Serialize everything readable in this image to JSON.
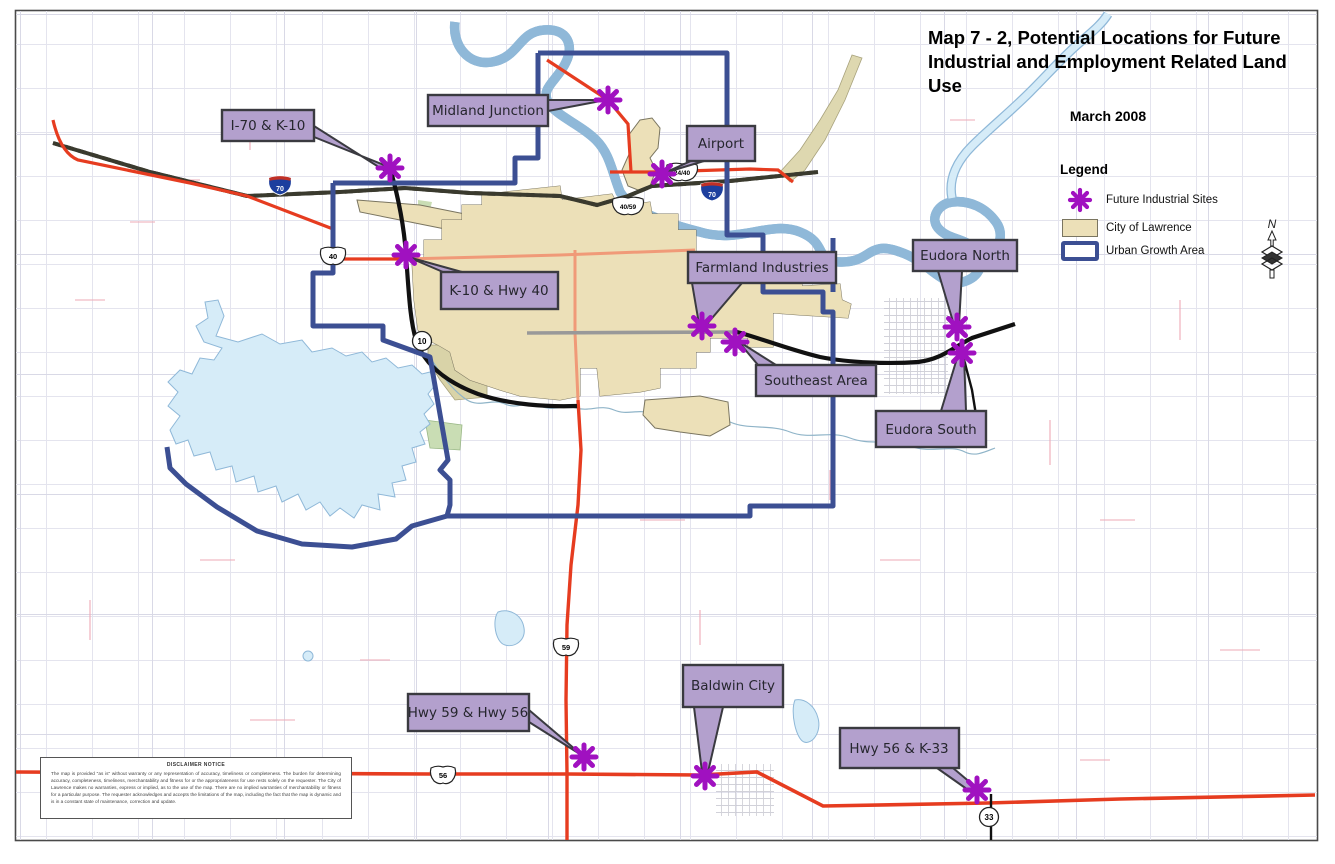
{
  "map": {
    "title": "Map 7 - 2, Potential Locations for Future Industrial and Employment Related Land Use",
    "date": "March 2008"
  },
  "legend": {
    "heading": "Legend",
    "items": [
      {
        "label": "Future Industrial Sites",
        "symbol": "purple-asterisk-marker",
        "color": "#A011C0"
      },
      {
        "label": "City of Lawrence",
        "symbol": "filled-swatch",
        "color": "#ECE0B8"
      },
      {
        "label": "Urban Growth Area",
        "symbol": "outlined-swatch",
        "color": "#3C4F93"
      }
    ]
  },
  "compass": {
    "north_label": "N"
  },
  "sites": [
    {
      "name": "I-70 & K-10"
    },
    {
      "name": "Midland Junction"
    },
    {
      "name": "Airport"
    },
    {
      "name": "K-10 & Hwy 40"
    },
    {
      "name": "Farmland Industries"
    },
    {
      "name": "Southeast Area"
    },
    {
      "name": "Eudora North"
    },
    {
      "name": "Eudora South"
    },
    {
      "name": "Hwy 59 & Hwy 56"
    },
    {
      "name": "Baldwin City"
    },
    {
      "name": "Hwy 56 & K-33"
    }
  ],
  "highway_shields": [
    {
      "system": "interstate",
      "label": "70"
    },
    {
      "system": "interstate",
      "label": "70"
    },
    {
      "system": "us-route",
      "label": "40"
    },
    {
      "system": "us-route",
      "label": "24/40"
    },
    {
      "system": "us-route",
      "label": "40/59"
    },
    {
      "system": "us-route",
      "label": "59"
    },
    {
      "system": "us-route",
      "label": "56"
    },
    {
      "system": "state-circle",
      "label": "10"
    },
    {
      "system": "state-circle",
      "label": "33"
    }
  ],
  "disclaimer": {
    "heading": "DISCLAIMER NOTICE",
    "body": "The map is provided \"as is\" without warranty or any representation of accuracy, timeliness or completeness.  The burden for determining accuracy, completeness, timeliness, merchantability and fitness for or the appropriateness for use rests solely on the requester.  The City of Lawrence makes no warranties, express or implied, as to the use of the map.  There are no implied warranties of merchantability or fitness for a particular purpose.  The requester acknowledges and accepts the limitations of the map, including the fact that the map is dynamic and is in a constant state of maintenance, correction and update."
  },
  "colors": {
    "industrial_site": "#A011C0",
    "city_fill": "#ECE0B8",
    "urban_growth": "#3C4F93",
    "callout_fill": "#B3A0CD",
    "water": "#D6ECF8",
    "highway_red": "#E63C20"
  }
}
